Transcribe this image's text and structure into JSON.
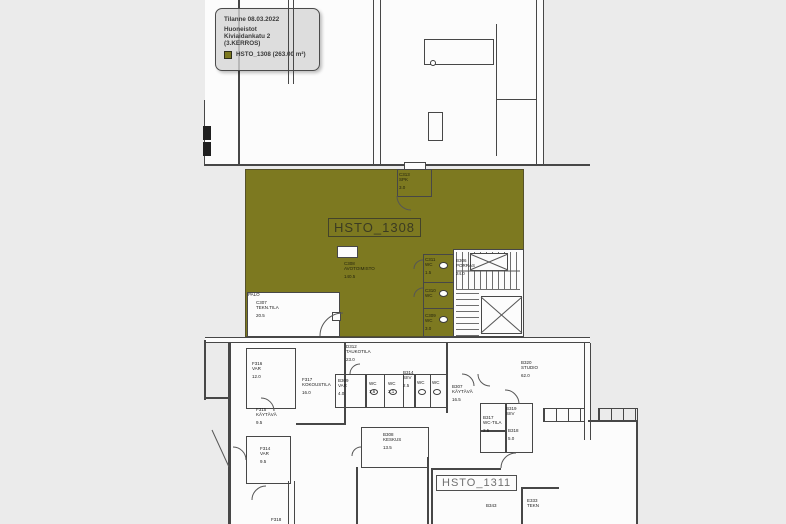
{
  "legend": {
    "status_line": "Tilanne 08.03.2022",
    "title": "Huoneistot",
    "address": "Kiviaidankatu 2",
    "floor": "(3.KERROS)",
    "item_label": "HSTO_1308 (263.00 m²)",
    "highlight_color": "#7d7920"
  },
  "plan": {
    "highlight_label": "HSTO_1308",
    "secondary_label": "HSTO_1311",
    "rooms": [
      {
        "code": "C313",
        "name": "SPK",
        "area": "3.0"
      },
      {
        "code": "C308",
        "name": "AVOTOIMISTO",
        "area": "140.5"
      },
      {
        "code": "C307",
        "name": "TEKN.TILA",
        "area": "20.5"
      },
      {
        "code": "C311",
        "name": "WC",
        "area": "1.5"
      },
      {
        "code": "C310",
        "name": "WC",
        "area": ""
      },
      {
        "code": "C309",
        "name": "WC",
        "area": "3.0"
      },
      {
        "code": "B306",
        "name": "PORRAS",
        "area": "24.0"
      },
      {
        "code": "D312",
        "name": "TAUKOTILA",
        "area": "23.0"
      },
      {
        "code": "F316",
        "name": "VAR",
        "area": "12.0"
      },
      {
        "code": "F317",
        "name": "KOKOUSTILA",
        "area": "16.0"
      },
      {
        "code": "B309",
        "name": "VAR",
        "area": "4.0"
      },
      {
        "code": "",
        "name": "WC",
        "area": "1.6"
      },
      {
        "code": "",
        "name": "WC",
        "area": "2.1"
      },
      {
        "code": "B314",
        "name": "SIIV",
        "area": "2.5"
      },
      {
        "code": "",
        "name": "WC",
        "area": ""
      },
      {
        "code": "",
        "name": "WC",
        "area": ""
      },
      {
        "code": "B307",
        "name": "KÄYTÄVÄ",
        "area": "16.5"
      },
      {
        "code": "B320",
        "name": "STUDIO",
        "area": "62.0"
      },
      {
        "code": "F315",
        "name": "KÄYTÄVÄ",
        "area": "9.5"
      },
      {
        "code": "F314",
        "name": "VAR",
        "area": "9.5"
      },
      {
        "code": "B308",
        "name": "KESKUS",
        "area": "13.5"
      },
      {
        "code": "B317",
        "name": "WC-TILA",
        "area": "2.5"
      },
      {
        "code": "B319",
        "name": "SIIV",
        "area": ""
      },
      {
        "code": "B318",
        "name": "",
        "area": "5.0"
      },
      {
        "code": "B343",
        "name": "",
        "area": ""
      },
      {
        "code": "E333",
        "name": "TEKN",
        "area": ""
      },
      {
        "code": "F318",
        "name": "",
        "area": ""
      },
      {
        "code": "PALO",
        "name": "",
        "area": ""
      }
    ]
  }
}
